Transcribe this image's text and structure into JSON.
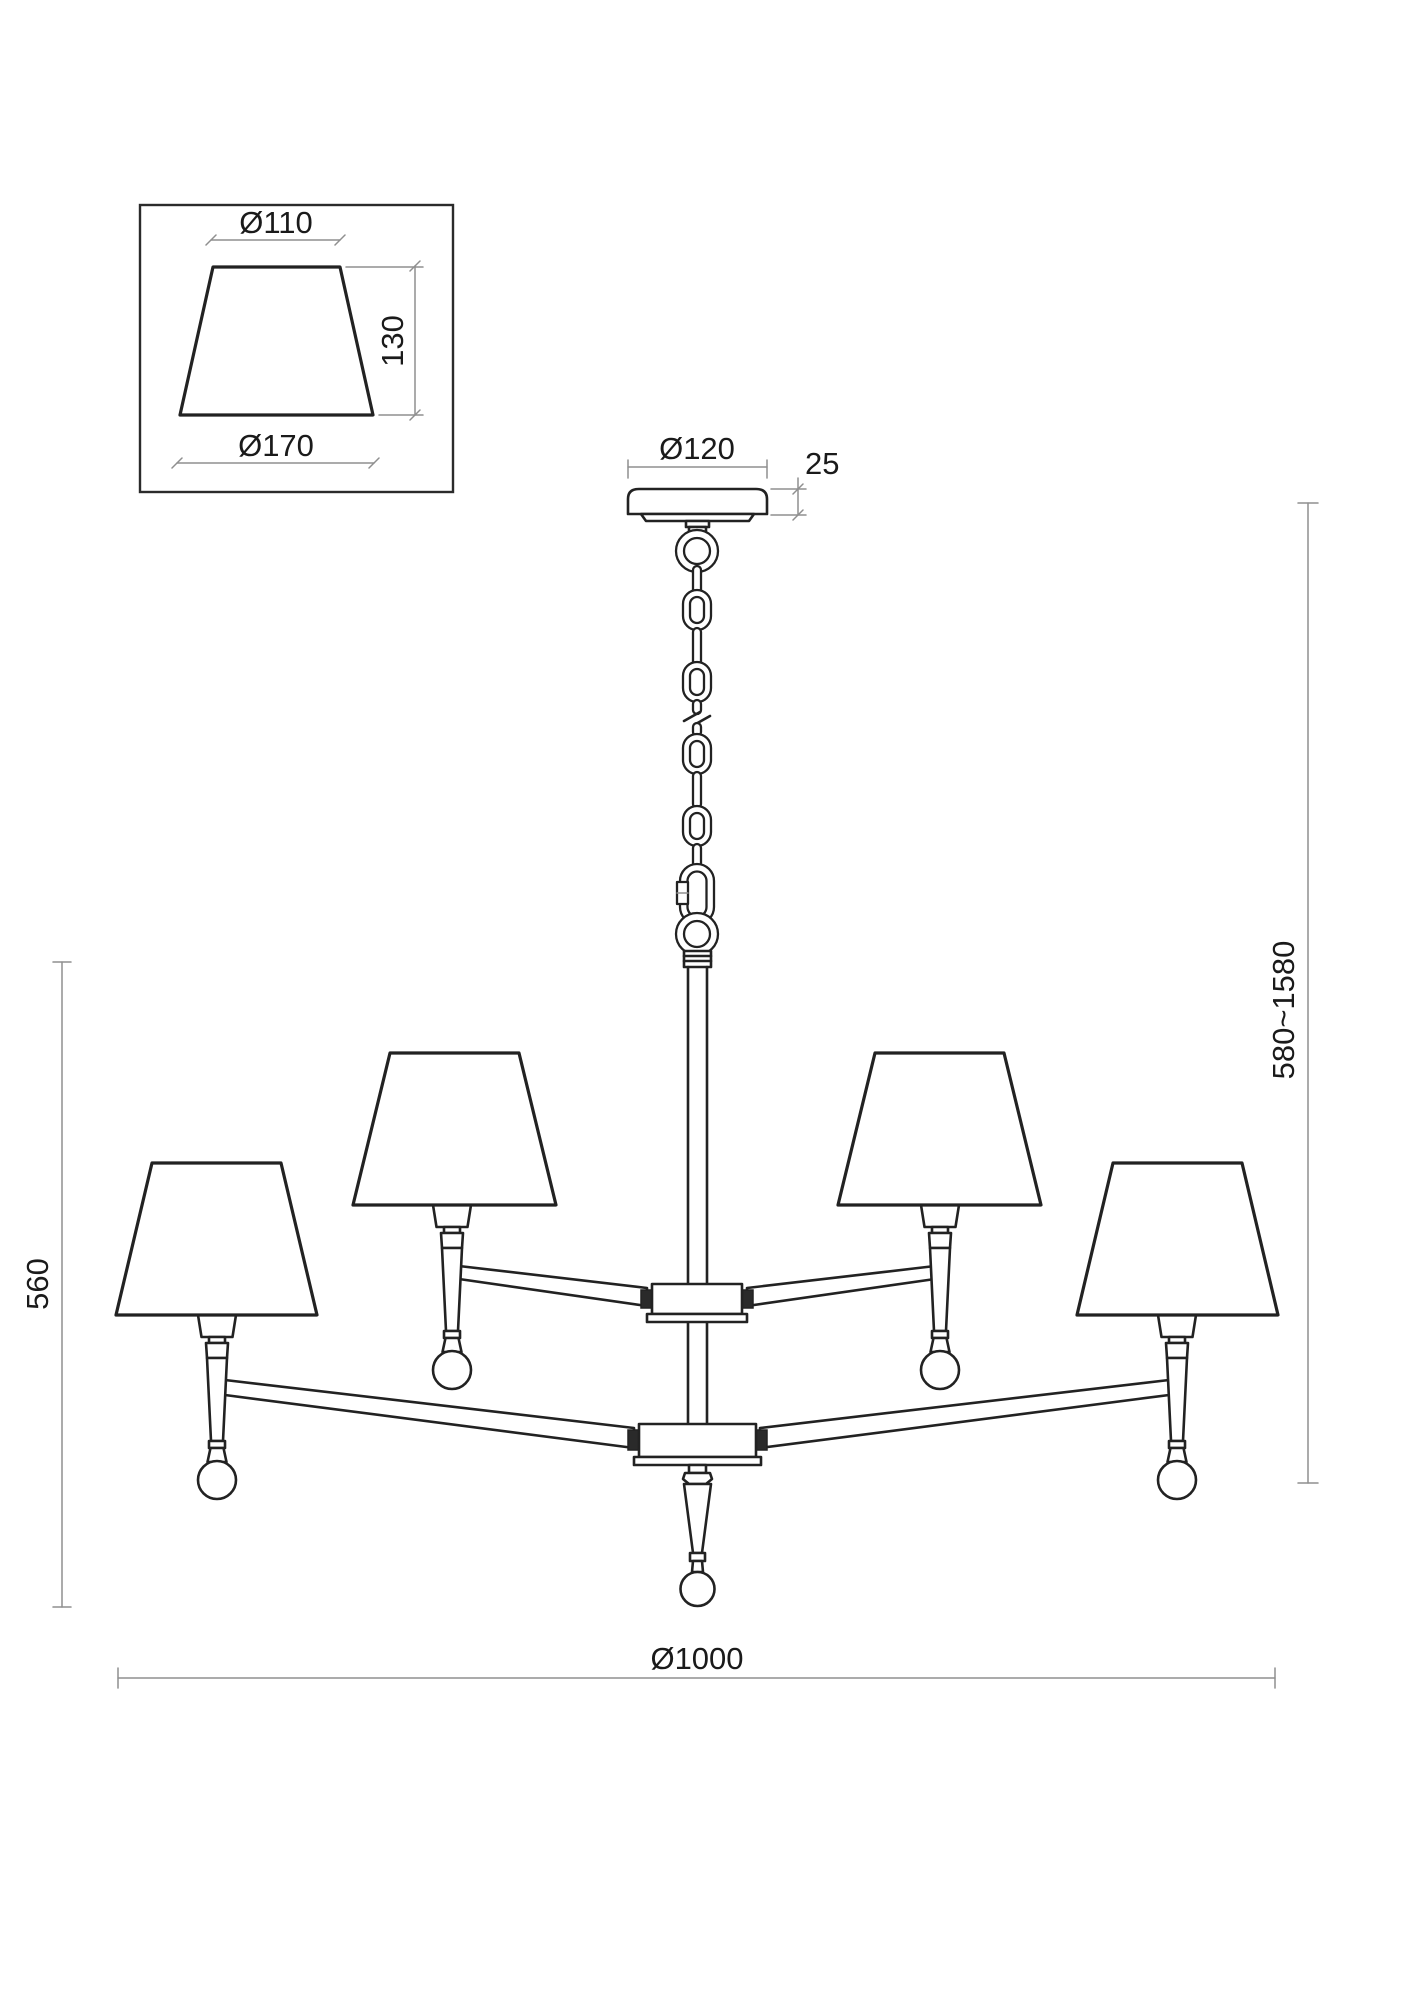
{
  "drawing": {
    "type": "chandelier dimensional line drawing",
    "colors": {
      "background": "#ffffff",
      "outline": "#222222",
      "dimension_line": "#8f8f8f",
      "dimension_text": "#1a1a1a"
    },
    "labels": {
      "detail_top_diameter": "Ø110",
      "detail_height": "130",
      "detail_bottom_diameter": "Ø170",
      "canopy_diameter": "Ø120",
      "canopy_height": "25",
      "suspension_height_range": "580~1580",
      "fixture_height": "560",
      "fixture_diameter": "Ø1000"
    }
  }
}
